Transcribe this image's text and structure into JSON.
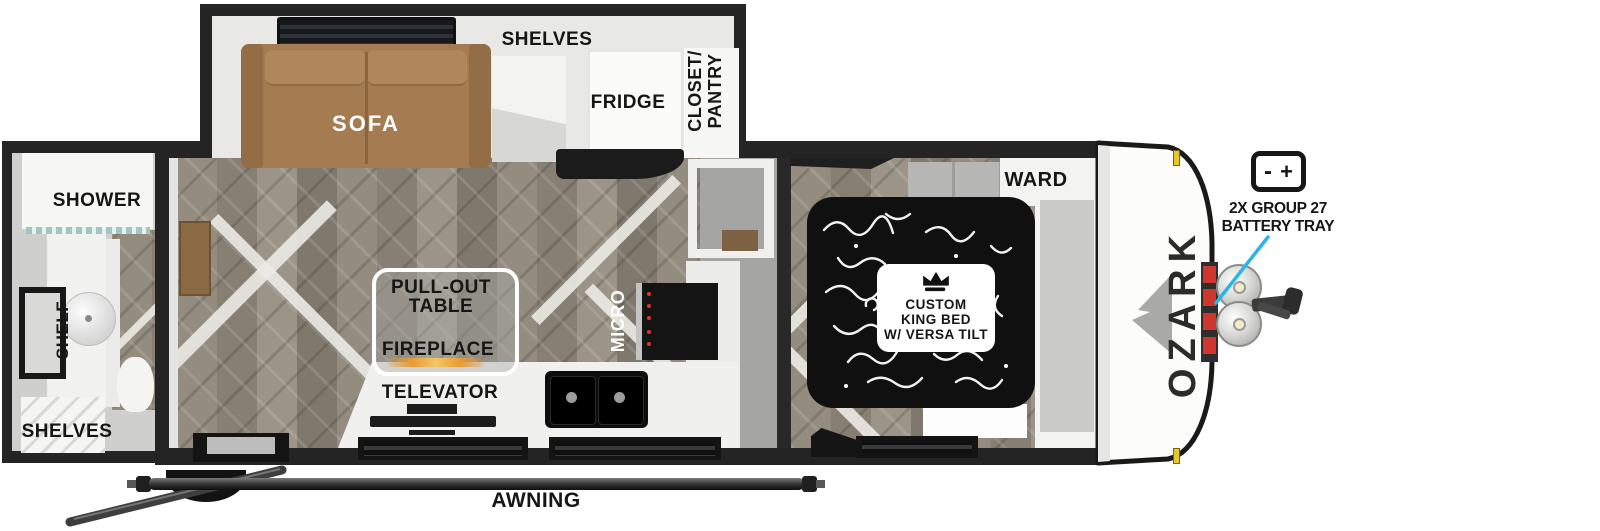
{
  "brand": {
    "name": "OZARK"
  },
  "rooms": {
    "bath": {
      "shower": "SHOWER",
      "shelf": "SHELF",
      "shelves": "SHELVES"
    },
    "slide": {
      "sofa": "SOFA",
      "shelves": "SHELVES",
      "fridge": "FRIDGE",
      "closet_line1": "CLOSET/",
      "closet_line2": "PANTRY"
    },
    "living": {
      "pullout_line1": "PULL-OUT",
      "pullout_line2": "TABLE",
      "fireplace": "FIREPLACE",
      "televator": "TELEVATOR",
      "micro": "MICRO"
    },
    "bedroom": {
      "ward": "WARD",
      "bed_line1": "CUSTOM",
      "bed_line2": "KING BED",
      "bed_line3": "W/ VERSA TILT"
    }
  },
  "exterior": {
    "awning": "AWNING",
    "battery_line1": "2X GROUP 27",
    "battery_line2": "BATTERY TRAY",
    "battery_minus": "-",
    "battery_plus": "+"
  },
  "colors": {
    "wall": "#242424",
    "floor": "#8e887c",
    "sofa": "#a57c52",
    "callout_line": "#2ab4e8",
    "battery_red": "#cf372e",
    "clearance_light": "#e9c62a",
    "fireplace_flame": "#e89a33"
  }
}
